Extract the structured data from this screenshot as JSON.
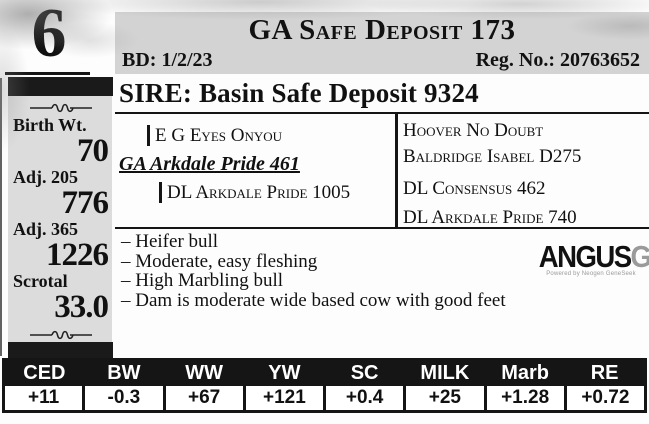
{
  "lot": {
    "number": "6"
  },
  "header": {
    "title": "GA Safe Deposit 173",
    "birth_date": "BD: 1/2/23",
    "registration": "Reg. No.: 20763652"
  },
  "stats": {
    "items": [
      {
        "label": "Birth Wt.",
        "value": "70"
      },
      {
        "label": "Adj. 205",
        "value": "776"
      },
      {
        "label": "Adj. 365",
        "value": "1226"
      },
      {
        "label": "Scrotal",
        "value": "33.0"
      }
    ]
  },
  "sire": {
    "heading": "SIRE: Basin Safe Deposit 9324"
  },
  "pedigree": {
    "maternal_grandsire": "E G Eyes Onyou",
    "dam": "GA Arkdale Pride 461",
    "maternal_granddam": "DL Arkdale Pride 1005",
    "ancestors": [
      "Hoover No Doubt",
      "Baldridge Isabel D275",
      "DL Consensus 462",
      "DL Arkdale Pride 740"
    ]
  },
  "notes": [
    "– Heifer bull",
    "– Moderate, easy fleshing",
    "– High Marbling bull",
    "– Dam is moderate wide based cow with good feet"
  ],
  "logo": {
    "brand": "ANGUS",
    "suffix": "GS",
    "tagline": "Powered by Neogen GeneSeek"
  },
  "icons": {
    "ornament_icon": "wavy-rule-divider"
  },
  "colors": {
    "header_bg": "#d3d3d3",
    "sidebar_bg": "#dcdcdc",
    "bar_black": "#1a1a1a",
    "table_header_bg": "#151515",
    "logo_gray": "#9a9a9a"
  },
  "epd": {
    "columns": [
      "CED",
      "BW",
      "WW",
      "YW",
      "SC",
      "MILK",
      "Marb",
      "RE"
    ],
    "values": [
      "+11",
      "-0.3",
      "+67",
      "+121",
      "+0.4",
      "+25",
      "+1.28",
      "+0.72"
    ]
  }
}
